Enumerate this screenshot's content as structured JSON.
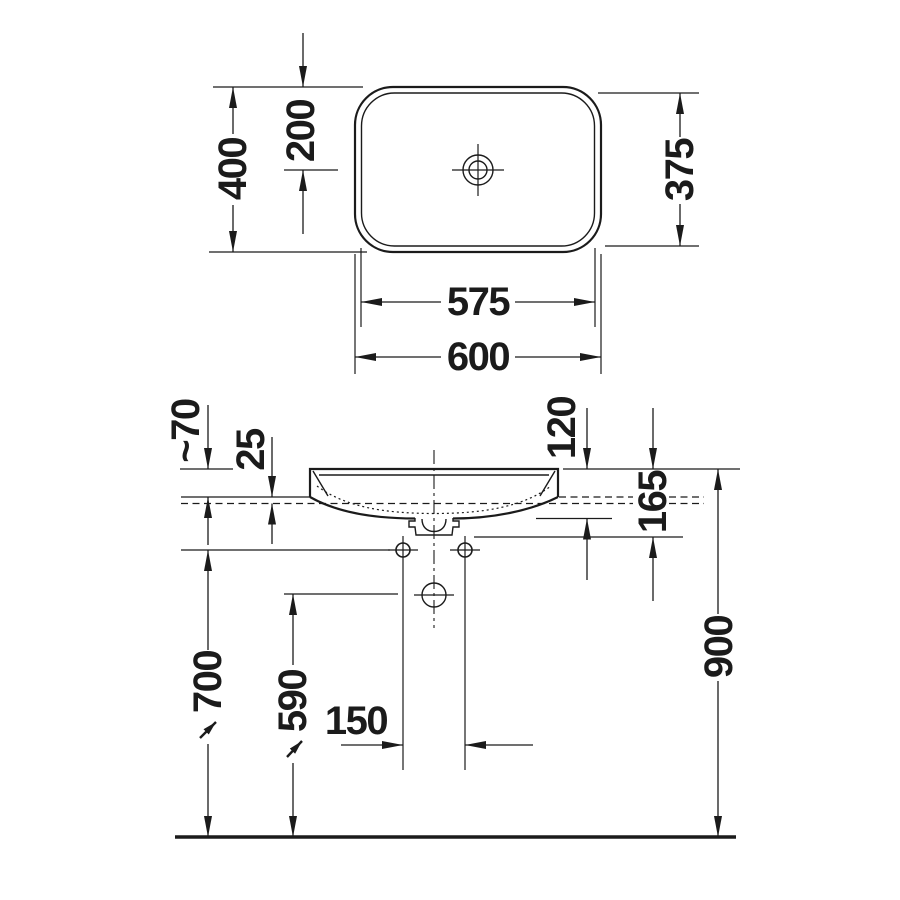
{
  "colors": {
    "line": "#1b1b1b",
    "background": "#ffffff"
  },
  "plan_view": {
    "outer_width": "600",
    "inner_width": "575",
    "outer_depth": "400",
    "inner_depth": "375",
    "drain_center_offset": "200"
  },
  "front_view": {
    "rim_above_counter": "~70",
    "counter_thickness": "25",
    "bowl_depth": "120",
    "overall_depth": "165",
    "hole_spacing": "150",
    "drain_height": "590",
    "fixing_height": "700",
    "rim_height": "900"
  }
}
